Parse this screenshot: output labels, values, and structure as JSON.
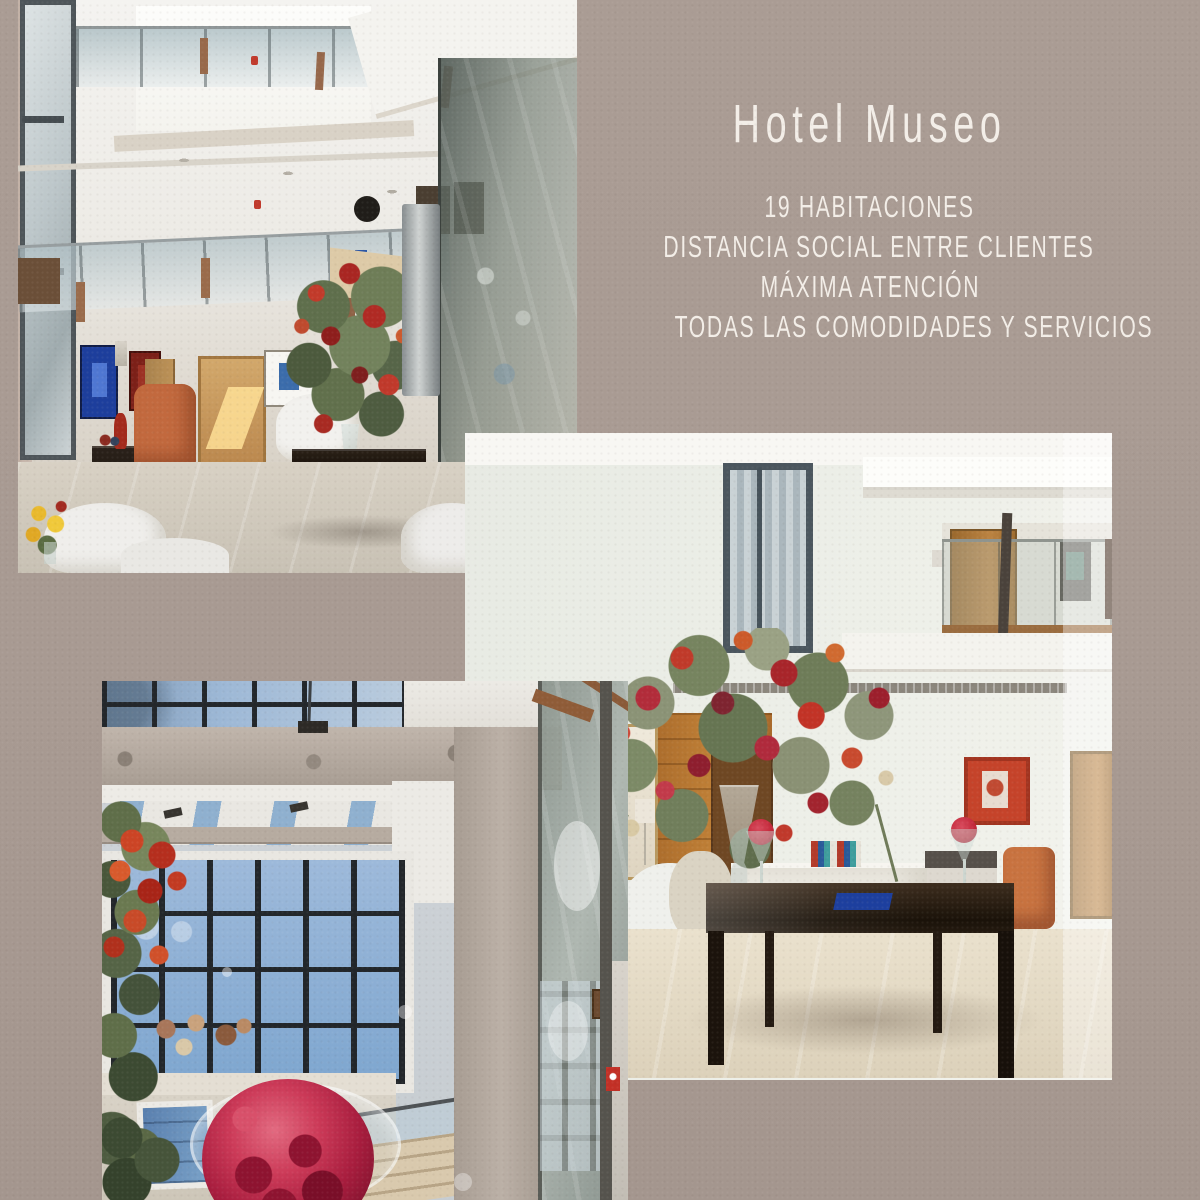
{
  "caption": {
    "title": "Hotel Museo",
    "features": [
      "19 HABITACIONES",
      "DISTANCIA SOCIAL ENTRE CLIENTES",
      "MÁXIMA ATENCIÓN",
      "TODAS LAS COMODIDADES Y SERVICIOS"
    ]
  },
  "palette": {
    "background": "#a89a92",
    "caption_text": "#f3eee8",
    "flower_red": "#b02a3c",
    "wood_panel": "#b5742f",
    "sky_blue": "#8fb0d0"
  },
  "photos": [
    {
      "id": "atrium",
      "alt": "Multi-storey hotel atrium with skylight, glass balustrades, artwork, flower arrangement and lounge seating"
    },
    {
      "id": "lobby",
      "alt": "Hotel lobby with large flower arrangement in glass vase on dark table, wood panelling, red painting and oak doors"
    },
    {
      "id": "skylight",
      "alt": "View up through a glass door to a gridded skylight with blue sky and a red flower ball in a glass bowl"
    }
  ]
}
